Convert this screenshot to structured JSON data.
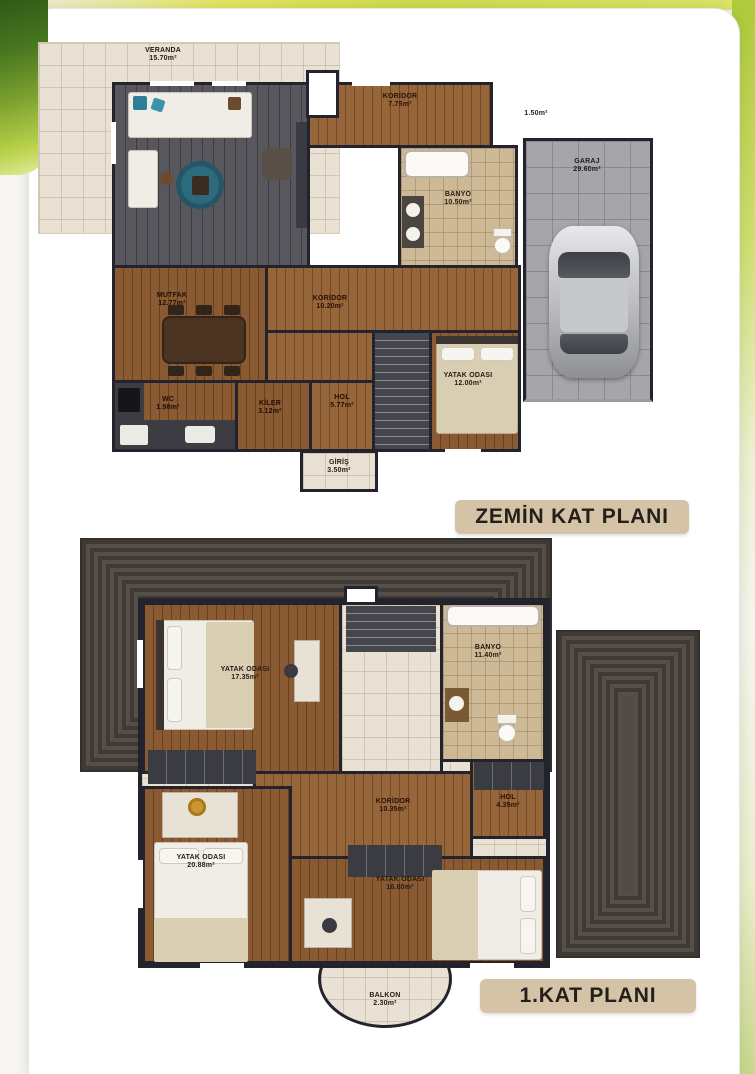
{
  "page": {
    "ground_floor": {
      "title": "ZEMİN KAT PLANI",
      "rooms": {
        "veranda": {
          "name": "VERANDA",
          "area": "15.70m²"
        },
        "koridor_top": {
          "name": "KORİDOR",
          "area": "7.75m²"
        },
        "balcony_small": {
          "name": "",
          "area": "1.50m²"
        },
        "banyo": {
          "name": "BANYO",
          "area": "10.50m²"
        },
        "garaj": {
          "name": "GARAJ",
          "area": "29.60m²"
        },
        "mutfak": {
          "name": "MUTFAK",
          "area": "12.77m²"
        },
        "koridor_mid": {
          "name": "KORİDOR",
          "area": "10.20m²"
        },
        "yatak_odasi": {
          "name": "YATAK ODASI",
          "area": "12.00m²"
        },
        "wc": {
          "name": "WC",
          "area": "1.98m²"
        },
        "kiler": {
          "name": "KİLER",
          "area": "3.12m²"
        },
        "hol": {
          "name": "HOL",
          "area": "5.77m²"
        },
        "giris": {
          "name": "GİRİŞ",
          "area": "3.50m²"
        }
      }
    },
    "first_floor": {
      "title": "1.KAT PLANI",
      "rooms": {
        "yatak_odasi_1": {
          "name": "YATAK ODASI",
          "area": "17.35m²"
        },
        "banyo": {
          "name": "BANYO",
          "area": "11.40m²"
        },
        "koridor": {
          "name": "KORİDOR",
          "area": "10.35m²"
        },
        "hol": {
          "name": "HOL",
          "area": "4.35m²"
        },
        "yatak_odasi_2": {
          "name": "YATAK ODASI",
          "area": "20.88m²"
        },
        "yatak_odasi_3": {
          "name": "YATAK ODASI",
          "area": "16.80m²"
        },
        "balkon": {
          "name": "BALKON",
          "area": "2.30m²"
        }
      }
    },
    "colors": {
      "badge_bg": "#d5c3a8",
      "wall": "#23232d",
      "wood_floor": "#8a5a33",
      "roof": "#514b45",
      "grass_accent": "#aecb3a"
    }
  }
}
